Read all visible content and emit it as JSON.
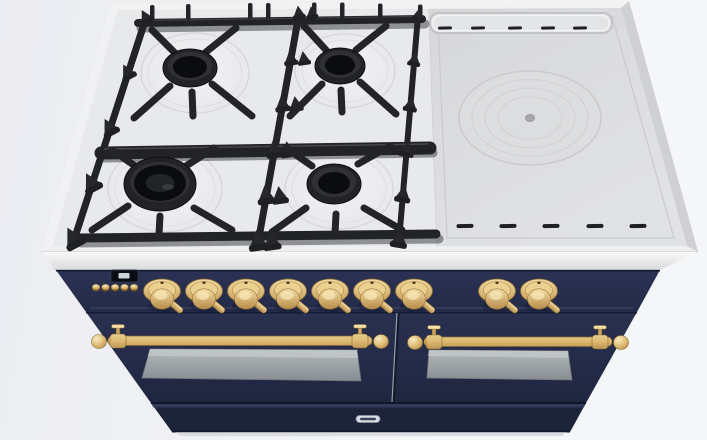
{
  "product": {
    "category": "range-cooker",
    "description": "Top-front 3D render of a 48-inch dual-fuel range: midnight blue body, brass knobs and rail handles, four-burner gas cooktop on the left, french-top griddle plate on the right, two oven doors.",
    "body_color_name": "midnight-blue",
    "trim_color_name": "brass"
  },
  "colors": {
    "background_left": "#ebecf1",
    "background_right": "#f5f6f8",
    "cooktop_surface": "#e8e9eb",
    "cooktop_rim": "#d7d8da",
    "griddle_plate": "#dadbdd",
    "griddle_ring": "#c9cacc",
    "grate_dark": "#232427",
    "burner_black": "#16171a",
    "steel_band_light": "#f8f8f9",
    "steel_band_dark": "#d9dadc",
    "body_navy": "#242b48",
    "panel_navy_top": "#2b3254",
    "kickplate_navy": "#1d2339",
    "brass_light": "#f4e0a6",
    "brass_mid": "#ddba72",
    "brass_dark": "#a87f3e",
    "glass_light": "#b4b9bc",
    "glass_dark": "#878d91",
    "display_bg": "#0a0d14",
    "display_screen": "#ccd4dc",
    "badge_bg": "#d7dbe2",
    "vent_slot": "#1f2022"
  },
  "cooktop": {
    "gas_burners": [
      {
        "name": "rear-left-burner",
        "cx": 190,
        "cy": 68,
        "bowl_rx": 54,
        "bowl_ry": 40,
        "head_rx": 27,
        "head_ry": 19,
        "cap_rx": 17,
        "cap_ry": 11,
        "dual_ring": false
      },
      {
        "name": "rear-right-burner",
        "cx": 340,
        "cy": 66,
        "bowl_rx": 50,
        "bowl_ry": 37,
        "head_rx": 25,
        "head_ry": 18,
        "cap_rx": 15,
        "cap_ry": 10,
        "dual_ring": false
      },
      {
        "name": "front-left-burner",
        "cx": 160,
        "cy": 184,
        "bowl_rx": 57,
        "bowl_ry": 43,
        "head_rx": 36,
        "head_ry": 27,
        "cap_rx": 26,
        "cap_ry": 18,
        "dual_ring": true
      },
      {
        "name": "front-right-burner",
        "cx": 334,
        "cy": 184,
        "bowl_rx": 54,
        "bowl_ry": 40,
        "head_rx": 27,
        "head_ry": 20,
        "cap_rx": 16,
        "cap_ry": 11,
        "dual_ring": false
      }
    ],
    "french_top": {
      "cx": 530,
      "cy": 118,
      "outer_rx": 71,
      "outer_ry": 47,
      "ring_count": 3,
      "center_cap_rx": 4.5,
      "center_cap_ry": 3.5
    },
    "top_vents": {
      "y": 28,
      "xs": [
        445,
        478,
        515,
        548,
        580
      ],
      "w": 14,
      "h": 3
    },
    "bottom_vents": {
      "y": 226,
      "xs": [
        465,
        508,
        551,
        595,
        638
      ],
      "w": 17,
      "h": 4
    }
  },
  "control_panel": {
    "display": {
      "x": 111,
      "y": 270,
      "w": 27,
      "h": 12
    },
    "buttons": {
      "cy": 287,
      "xs": [
        96,
        105.5,
        115,
        124.5,
        134
      ]
    },
    "knobs": {
      "cy": 291,
      "xs": [
        162,
        204,
        246,
        288,
        330,
        372,
        414,
        497,
        539
      ]
    }
  },
  "oven": {
    "left_handle": {
      "x1": 108,
      "x2": 372,
      "y": 341,
      "posts": [
        118,
        360
      ]
    },
    "right_handle": {
      "x1": 424,
      "x2": 612,
      "y": 342,
      "posts": [
        434,
        600
      ]
    },
    "divider_x_top": 397,
    "divider_x_bottom": 392
  },
  "badge": {
    "cx": 368,
    "cy": 419,
    "w": 24,
    "h": 7,
    "text_legible": false
  }
}
